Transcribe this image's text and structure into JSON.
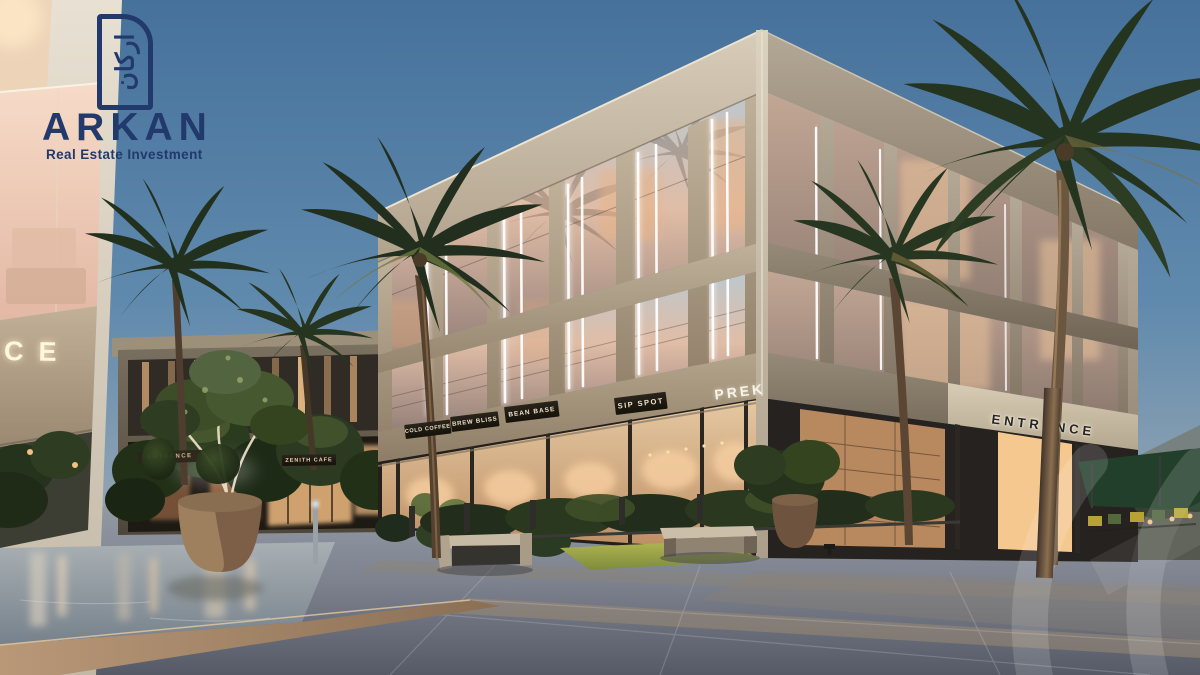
{
  "brand": {
    "name": "ARKAN",
    "tagline": "Real Estate Investment",
    "logomark_glyph": "اركان",
    "navy": "#21396b"
  },
  "signs": {
    "storefronts": [
      {
        "label": "COLD COFFEE"
      },
      {
        "label": "BREW BLISS"
      },
      {
        "label": "BEAN BASE"
      },
      {
        "label": "SIP SPOT"
      },
      {
        "label": "PREK"
      }
    ],
    "entrance": "ENTRANCE",
    "left_building_partial": "CE",
    "background_cafe": "ZENITH CAFE",
    "background_entrance": "ENTRANCE"
  },
  "palette": {
    "sky_top": "#46719b",
    "sky_horizon": "#c8bcab",
    "concrete_lit": "#d8cdba",
    "concrete_shade": "#85786 7",
    "glass_warm": "#e0bda6",
    "storefront_glow": "#f6d7ae",
    "led_strip": "#ffffff",
    "palm_green": "#253522",
    "pavement": "#7d828e",
    "water": "#a9b0b4"
  }
}
